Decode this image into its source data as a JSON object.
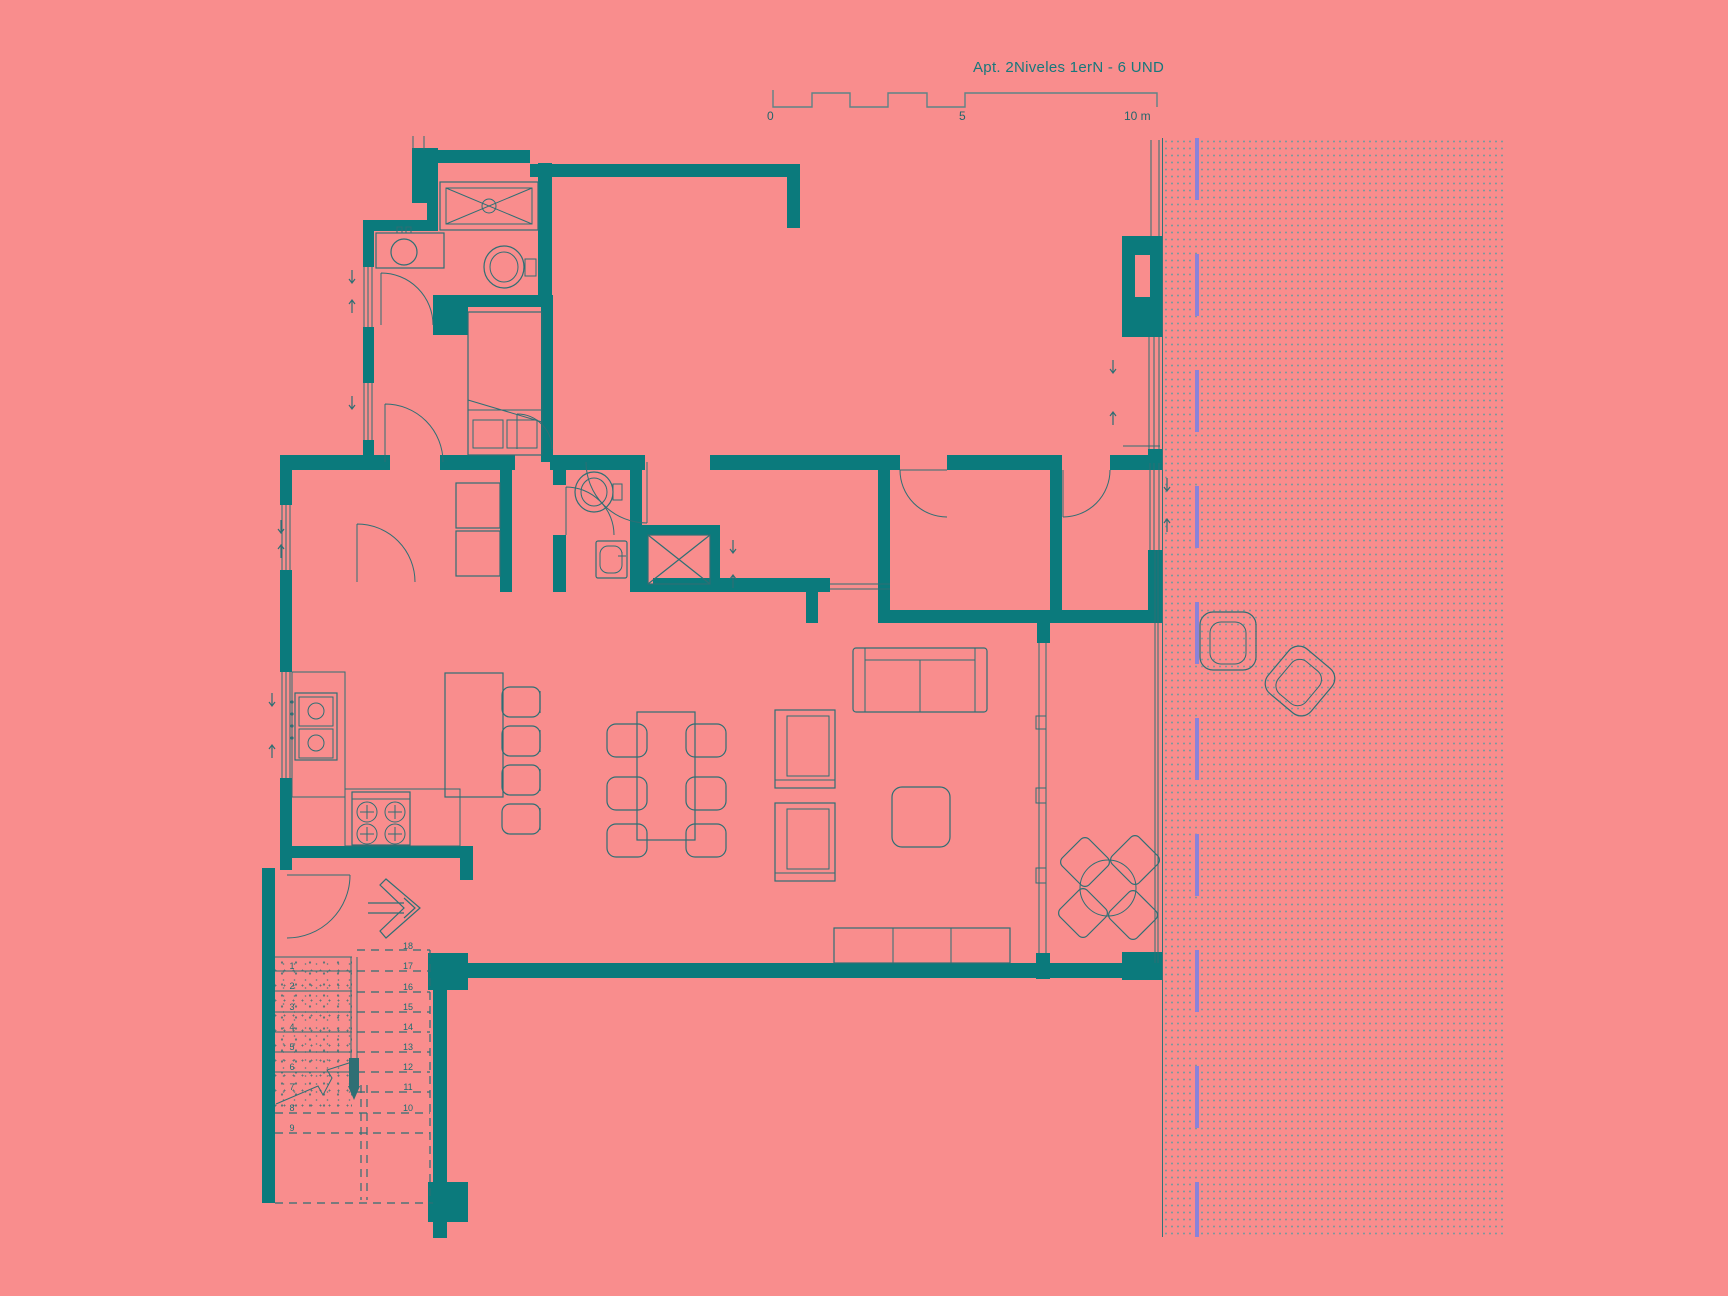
{
  "title": "Apt. 2Niveles 1erN - 6 UND",
  "scale_bar": {
    "labels": [
      "0",
      "5",
      "10 m"
    ],
    "units_meters": [
      0,
      5,
      10
    ]
  },
  "stairs": {
    "left_numbers": [
      "1",
      "2",
      "3",
      "4",
      "5",
      "6",
      "7",
      "8",
      "9"
    ],
    "right_numbers": [
      "18",
      "17",
      "16",
      "15",
      "14",
      "13",
      "12",
      "11",
      "10"
    ]
  },
  "colors": {
    "background": "#f98d8d",
    "wall": "#0b7a7c",
    "thin_line": "#2f6f74",
    "text": "#16787c",
    "datum_dash": "#8a82d9",
    "hatch_dot": "#7e999c"
  },
  "rooms_fixtures": [
    "shower",
    "bathroom-sink",
    "toilet",
    "bed",
    "closet-shelves",
    "second-toilet",
    "second-sink",
    "elevator-shaft",
    "kitchen-sink",
    "stove",
    "kitchen-island",
    "bar-stools",
    "dining-table",
    "dining-chairs",
    "sofa",
    "armchairs",
    "coffee-table",
    "sideboard",
    "sliding-glass-door",
    "terrace-dining-set",
    "lounge-chairs",
    "staircase",
    "entrance-arrow"
  ]
}
